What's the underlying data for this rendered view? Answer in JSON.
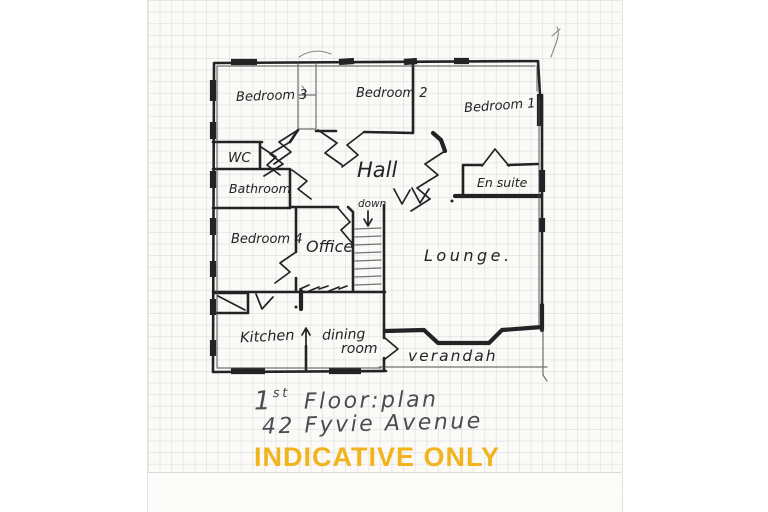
{
  "watermark": {
    "text": "INDICATIVE ONLY",
    "color": "#F2B41E"
  },
  "caption": {
    "line1_number": "1",
    "line1_superscript": "st",
    "line1_rest": "Floor:plan",
    "line2": "42 Fyvie Avenue"
  },
  "stairs": {
    "label": "down"
  },
  "rooms": {
    "bedroom3": {
      "label": "Bedroom 3"
    },
    "bedroom2": {
      "label": "Bedroom 2"
    },
    "bedroom1": {
      "label": "Bedroom 1"
    },
    "wc": {
      "label": "WC"
    },
    "hall": {
      "label": "Hall"
    },
    "ensuite": {
      "label": "En suite"
    },
    "bathroom": {
      "label": "Bathroom"
    },
    "bedroom4": {
      "label": "Bedroom 4"
    },
    "office": {
      "label": "Office"
    },
    "lounge": {
      "label": "Lounge."
    },
    "kitchen": {
      "label": "Kitchen"
    },
    "dining": {
      "line1": "dining",
      "line2": "room"
    },
    "verandah": {
      "label": "verandah"
    }
  },
  "colors": {
    "ink": "#232326",
    "pencil": "#4b4c52",
    "paper": "#FBFAF7",
    "grid_line": "#C6CDD2",
    "watermark": "#F2B41E"
  }
}
